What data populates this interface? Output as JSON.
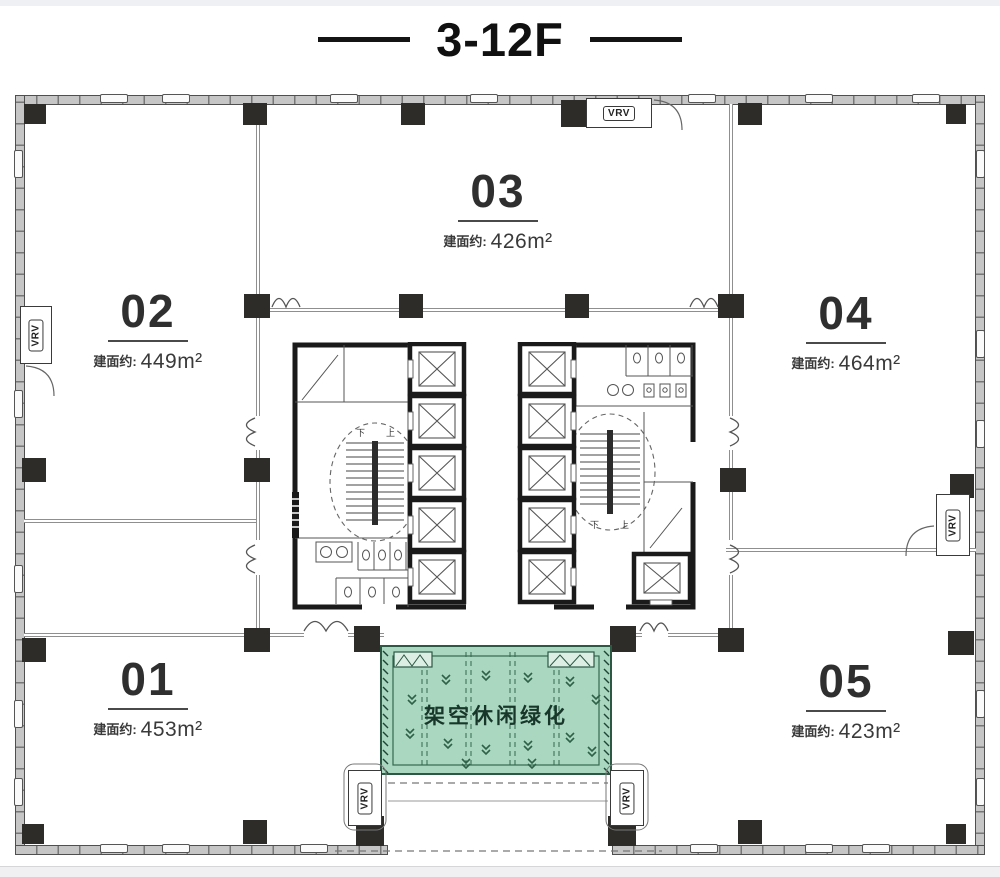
{
  "title": {
    "text": "3-12F"
  },
  "units": [
    {
      "number": "01",
      "area_label": "建面约:",
      "area_value": "453m²"
    },
    {
      "number": "02",
      "area_label": "建面约:",
      "area_value": "449m²"
    },
    {
      "number": "03",
      "area_label": "建面约:",
      "area_value": "426m²"
    },
    {
      "number": "04",
      "area_label": "建面约:",
      "area_value": "464m²"
    },
    {
      "number": "05",
      "area_label": "建面约:",
      "area_value": "423m²"
    }
  ],
  "green_area": {
    "label": "架空休闲绿化"
  },
  "hvac": {
    "vrv_label": "VRV"
  },
  "stairs": {
    "down_label": "下",
    "up_label": "上"
  }
}
